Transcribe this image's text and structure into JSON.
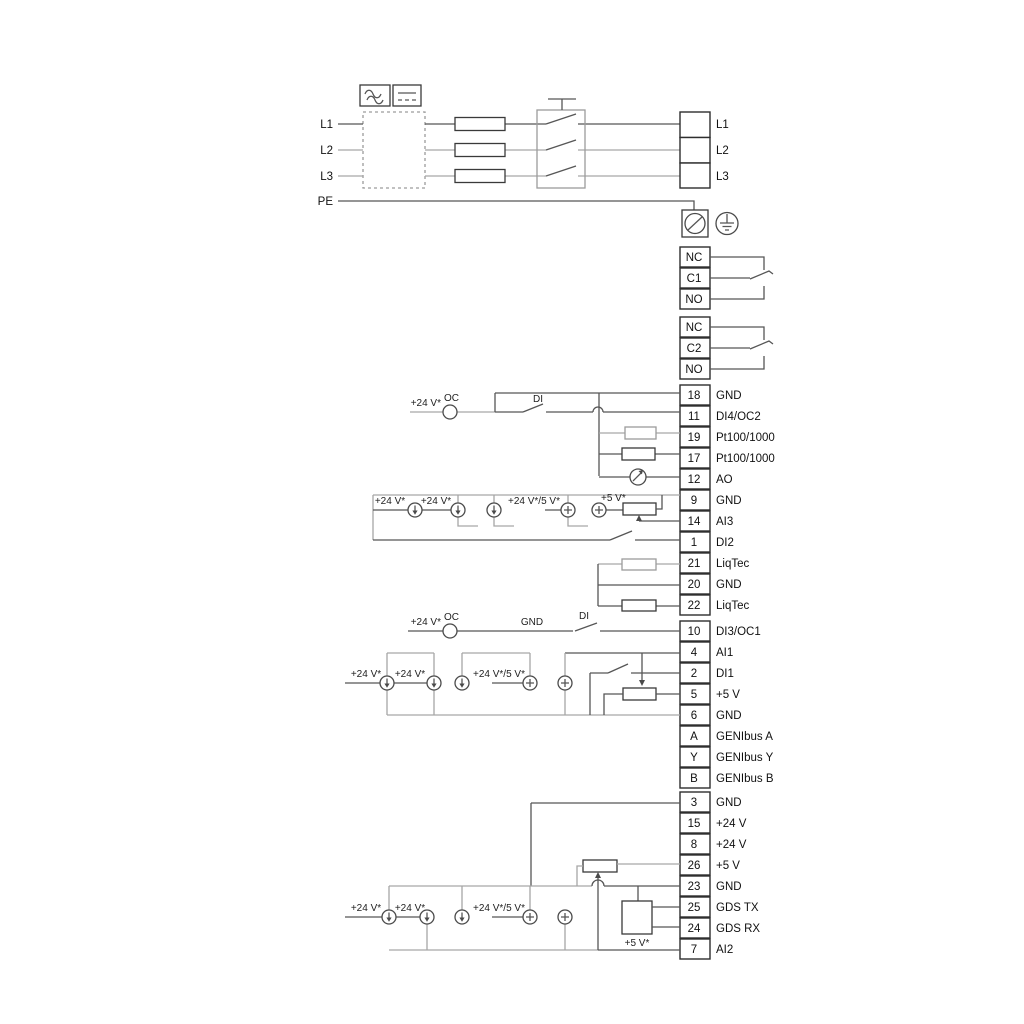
{
  "labels": {
    "v24": "+24 V*",
    "oc": "OC",
    "di": "DI",
    "gnd": "GND",
    "v24v5": "+24 V*/5 V*",
    "v5": "+5 V*"
  },
  "power": {
    "in": [
      "L1",
      "L2",
      "L3",
      "PE"
    ],
    "out": [
      "L1",
      "L2",
      "L3"
    ]
  },
  "relay1": [
    "NC",
    "C1",
    "NO"
  ],
  "relay2": [
    "NC",
    "C2",
    "NO"
  ],
  "g1": [
    {
      "no": "18",
      "t": "GND"
    },
    {
      "no": "11",
      "t": "DI4/OC2"
    },
    {
      "no": "19",
      "t": "Pt100/1000"
    },
    {
      "no": "17",
      "t": "Pt100/1000"
    },
    {
      "no": "12",
      "t": "AO"
    },
    {
      "no": "9",
      "t": "GND"
    },
    {
      "no": "14",
      "t": "AI3"
    },
    {
      "no": "1",
      "t": "DI2"
    }
  ],
  "g2": [
    {
      "no": "21",
      "t": "LiqTec"
    },
    {
      "no": "20",
      "t": "GND"
    },
    {
      "no": "22",
      "t": "LiqTec"
    }
  ],
  "g3": [
    {
      "no": "10",
      "t": "DI3/OC1"
    },
    {
      "no": "4",
      "t": "AI1"
    },
    {
      "no": "2",
      "t": "DI1"
    },
    {
      "no": "5",
      "t": "+5 V"
    },
    {
      "no": "6",
      "t": "GND"
    },
    {
      "no": "A",
      "t": "GENIbus A"
    },
    {
      "no": "Y",
      "t": "GENIbus Y"
    },
    {
      "no": "B",
      "t": "GENIbus B"
    }
  ],
  "g4": [
    {
      "no": "3",
      "t": "GND"
    },
    {
      "no": "15",
      "t": "+24 V"
    },
    {
      "no": "8",
      "t": "+24 V"
    },
    {
      "no": "26",
      "t": "+5 V"
    },
    {
      "no": "23",
      "t": "GND"
    },
    {
      "no": "25",
      "t": "GDS TX"
    },
    {
      "no": "24",
      "t": "GDS RX"
    },
    {
      "no": "7",
      "t": "AI2"
    }
  ]
}
